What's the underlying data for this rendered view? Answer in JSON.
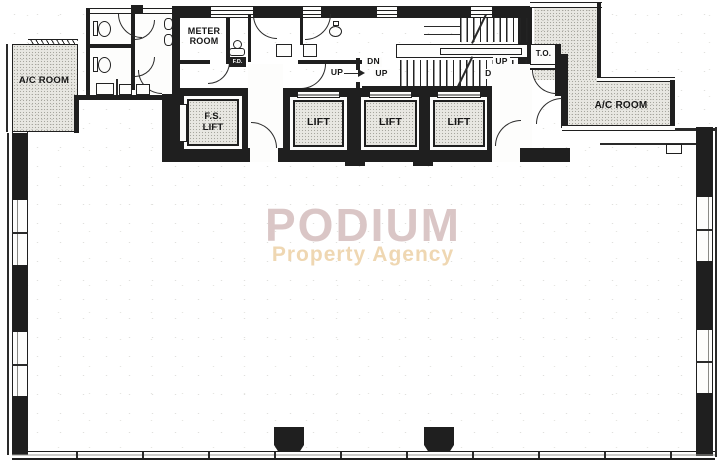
{
  "plan_type": "office-floor-plan",
  "rooms": {
    "ac_room_left": "A/C ROOM",
    "meter_room": "METER ROOM",
    "fs_lift": "F.S. LIFT",
    "lift_1": "LIFT",
    "lift_2": "LIFT",
    "lift_3": "LIFT",
    "td": "T.O.",
    "ac_room_right": "A/C ROOM"
  },
  "stairs": {
    "left_top": "DN",
    "left_bottom": "UP",
    "right_top": "UP",
    "right_bottom": "DN",
    "lobby": "UP"
  },
  "fixtures": {
    "fd": "F.D."
  },
  "watermark": {
    "title": "PODIUM",
    "subtitle": "Property Agency",
    "title_color": "#dac6c6",
    "subtitle_color": "#efd7b2"
  },
  "colors": {
    "wall": "#1f1f1f",
    "service_room_fill": "#e8e7e2",
    "floor": "#ffffff"
  }
}
